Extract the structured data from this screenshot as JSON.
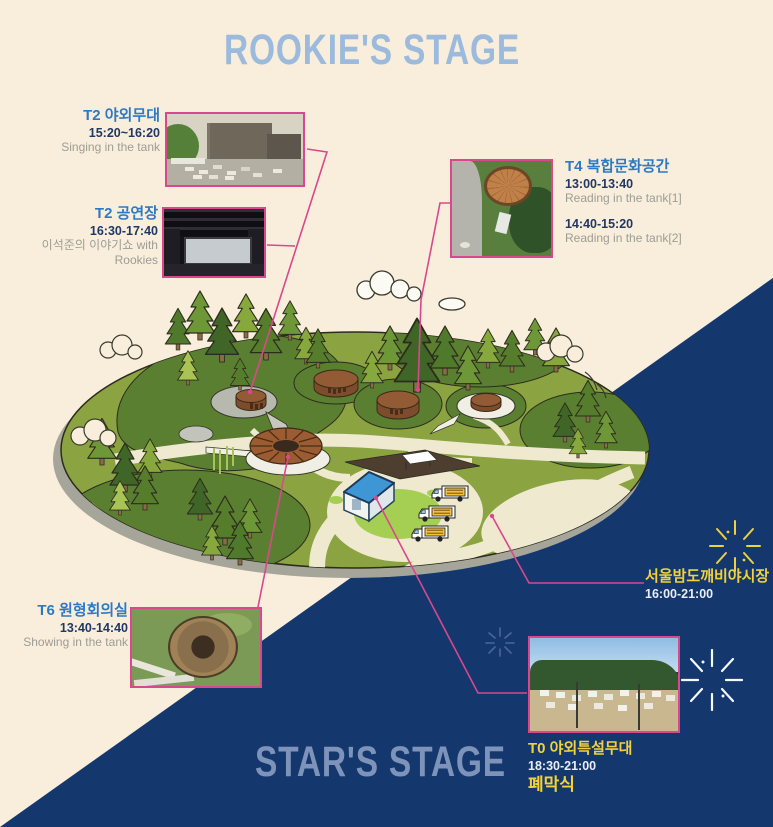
{
  "titles": {
    "top": "ROOKIE'S STAGE",
    "bottom": "STAR'S STAGE"
  },
  "events": {
    "t2_outdoor": {
      "name": "T2 야외무대",
      "time": "15:20~16:20",
      "desc": "Singing in the tank"
    },
    "t2_hall": {
      "name": "T2 공연장",
      "time": "16:30-17:40",
      "desc": "이석준의 이야기쇼 with Rookies"
    },
    "t4": {
      "name": "T4 복합문화공간",
      "time1": "13:00-13:40",
      "desc1": "Reading in the tank[1]",
      "time2": "14:40-15:20",
      "desc2": "Reading in the tank[2]"
    },
    "t6": {
      "name": "T6 원형회의실",
      "time": "13:40-14:40",
      "desc": "Showing in the tank"
    },
    "night_market": {
      "name": "서울밤도깨비야시장",
      "time": "16:00-21:00"
    },
    "t0": {
      "name": "T0 야외특설무대",
      "time": "18:30-21:00",
      "desc": "폐막식"
    }
  },
  "icons": [
    "sparkle-icon",
    "pine-tree-icon",
    "cloud-icon",
    "oil-tank-icon",
    "ring-tank-icon",
    "pavilion-icon",
    "food-truck-icon"
  ],
  "colors": {
    "background_cream": "#f9eedb",
    "background_navy": "#14386e",
    "accent_pink": "#d9488c",
    "label_blue": "#2d7ac4",
    "time_navy": "#203864",
    "desc_gray": "#9c9c96",
    "label_yellow": "#f2d13d",
    "title_top_blue": "#9cbbdc",
    "title_bottom_blue": "#7e93b9",
    "island_green": "#8ba441",
    "mound_green": "#5a7f31",
    "path_cream": "#efe9cf",
    "tank_brown": "#925a35"
  }
}
